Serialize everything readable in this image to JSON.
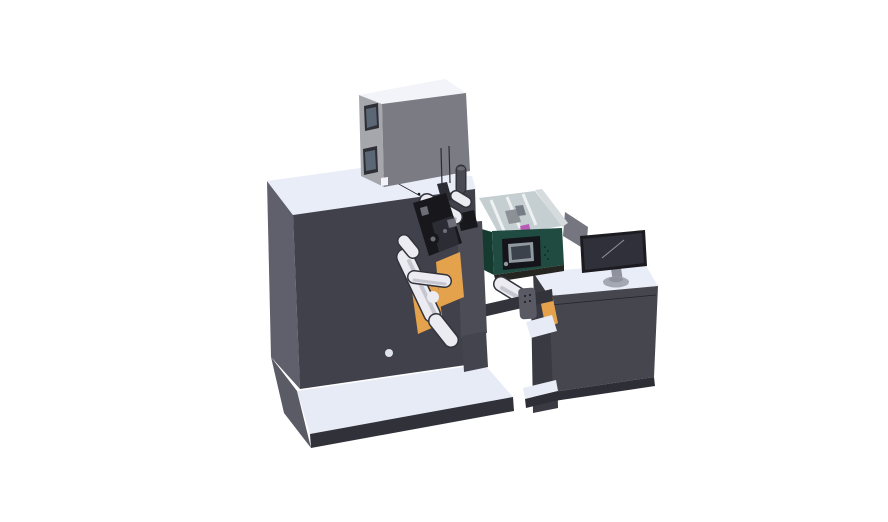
{
  "canvas": {
    "width": 888,
    "height": 522
  },
  "parts": [
    "main-cabinet",
    "base-platform",
    "control-box",
    "status-cylinder",
    "web-rollers",
    "orange-web-panels",
    "winder-mechanism",
    "front-plate",
    "print-hood",
    "printer-unit",
    "printer-control-panel",
    "control-pendant",
    "bridge-beam",
    "equipment-stand",
    "operator-desk",
    "monitor",
    "monitor-back-panel",
    "monitor-stand"
  ],
  "colors": {
    "background": "#ffffff",
    "seam": "#23232b",
    "machine_front": "#41414c",
    "machine_left": "#60606c",
    "machine_top": "#e9edf7",
    "base_top": "#e7ebf6",
    "base_side": "#5b5b66",
    "base_front": "#31313a",
    "box_left": "#a6a6ad",
    "box_top": "#f2f4f9",
    "box_front": "#7b7b84",
    "box_window_frame": "#2f2f37",
    "box_window_glass": "#5c6775",
    "cylinder_body": "#4a4a54",
    "cylinder_cap": "#6a6a74",
    "hood_floor": "#c5ced0",
    "hood_rim": "#9fa9ab",
    "hood_rail": "#eef1f2",
    "hood_wall": "#d6dcdd",
    "head_gray": "#8b9196",
    "head_gray2": "#767c83",
    "magenta": "#b85cb5",
    "green_front": "#1f4b40",
    "green_side": "#153a30",
    "green_edge": "#0e2d26",
    "green_dot": "#0f2e27",
    "under_shadow": "#252621",
    "panel_black": "#14141a",
    "panel_frame": "#9098a0",
    "screen_dark": "#3c424b",
    "orange": "#e4a24c",
    "orange_dark": "#b97f33",
    "plate": "#4c4c57",
    "column": "#44444e",
    "roller_outline": "#33333b",
    "roller_body": "#ebebf1",
    "roller_shade": "#c6c6d1",
    "mech_dark": "#17171c",
    "mech_mid": "#2c2c34",
    "mech_light": "#6e6e78",
    "beam": "#33333c",
    "pendant": "#5a5a64",
    "pendant_dot": "#22222a",
    "desk_top": "#e9edf7",
    "desk_front": "#46464f",
    "desk_side": "#3a3a43",
    "desk_base": "#2e2e36",
    "shelf_light": "#e7ebf5",
    "backpanel": "#757680",
    "monitor_bezel": "#1b1b21",
    "monitor_screen": "#30303a",
    "monitor_glint": "#9191a0",
    "stand_gray": "#8f929c",
    "stand_base": "#a3a8b2",
    "stand_rim": "#6d727c",
    "face_dot": "#dfe3ec"
  }
}
